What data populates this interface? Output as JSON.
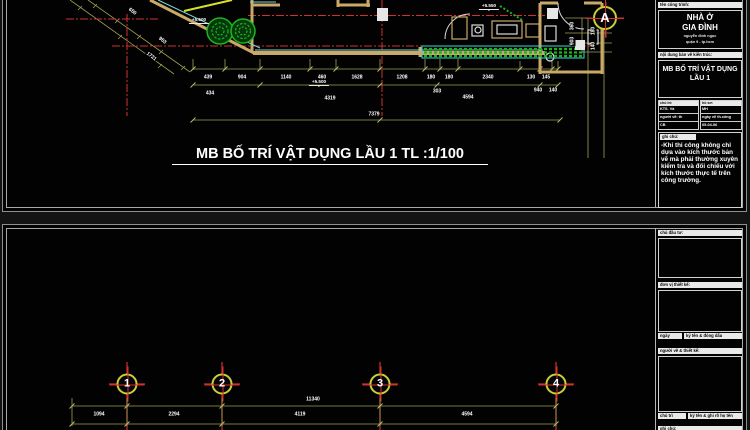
{
  "colors": {
    "wall": "#c9a868",
    "centerline": "#d23030",
    "dimension_line": "#9f9f55",
    "vegetation": "#1db31d",
    "cyan_accent": "#3ad6d6",
    "grid_bubble_ring": "#cbcd39",
    "sheet_frame": "#8f8f8f",
    "text": "#ffffff"
  },
  "sheet1": {
    "drawing_title": "MB BỐ TRÍ VẬT DỤNG LẦU 1 TL :1/100",
    "grid_bubbles": [
      {
        "t": "A",
        "x": 605,
        "y": 18
      }
    ],
    "levels": [
      {
        "t": "+5.500",
        "x": 199,
        "y": 17
      },
      {
        "t": "+5.500",
        "x": 319,
        "y": 79
      },
      {
        "t": "+5.550",
        "x": 489,
        "y": 3
      }
    ],
    "dims_row1": [
      {
        "t": "439",
        "x": 208,
        "y": 78
      },
      {
        "t": "904",
        "x": 242,
        "y": 78
      },
      {
        "t": "1140",
        "x": 286,
        "y": 78
      },
      {
        "t": "460",
        "x": 322,
        "y": 78
      },
      {
        "t": "1628",
        "x": 357,
        "y": 78
      },
      {
        "t": "1208",
        "x": 402,
        "y": 78
      },
      {
        "t": "180",
        "x": 431,
        "y": 78
      },
      {
        "t": "180",
        "x": 449,
        "y": 78
      },
      {
        "t": "2340",
        "x": 488,
        "y": 78
      },
      {
        "t": "130",
        "x": 531,
        "y": 78
      },
      {
        "t": "145",
        "x": 546,
        "y": 78
      }
    ],
    "dims_row2": [
      {
        "t": "434",
        "x": 210,
        "y": 94
      },
      {
        "t": "4319",
        "x": 330,
        "y": 99
      },
      {
        "t": "303",
        "x": 437,
        "y": 92
      },
      {
        "t": "940",
        "x": 538,
        "y": 91
      },
      {
        "t": "140",
        "x": 553,
        "y": 91
      },
      {
        "t": "4594",
        "x": 468,
        "y": 98
      }
    ],
    "dims_row3": [
      {
        "t": "7379",
        "x": 374,
        "y": 115
      }
    ],
    "dims_diag": [
      {
        "t": "650",
        "x": 132,
        "y": 12,
        "rot": 38
      },
      {
        "t": "953",
        "x": 162,
        "y": 41,
        "rot": 38
      },
      {
        "t": "1721",
        "x": 151,
        "y": 57,
        "rot": 38
      }
    ],
    "dims_vert": [
      {
        "t": "360",
        "x": 573,
        "y": 26,
        "rot": -90
      },
      {
        "t": "903",
        "x": 573,
        "y": 41,
        "rot": -90
      },
      {
        "t": "180",
        "x": 594,
        "y": 31,
        "rot": -90
      },
      {
        "t": "140",
        "x": 594,
        "y": 46,
        "rot": -90
      }
    ],
    "titleblock": {
      "header_project": "tên công trình:",
      "project_1": "NHÀ Ở",
      "project_2": "GIA ĐÌNH",
      "project_sub1": "nguyễn đình ngọc",
      "project_sub2": "quận 9 - tp.hcm",
      "header_drawing": "nội dung bản vẽ kiến trúc:",
      "drawing_1": "MB BỐ TRÍ VẬT DỤNG",
      "drawing_2": "LẦU 1",
      "left_col": {
        "header": "chủ trì:",
        "rows": [
          "KTS. Và",
          "người vẽ: th",
          "CB"
        ]
      },
      "right_col": {
        "header": "hồ sơ:",
        "rows": [
          "MH",
          "ngày vẽ th.công",
          "05-04-06"
        ]
      },
      "notes_header": "ghi chú:",
      "notes_body": "-Khi thi công không chỉ dựa vào kích thước bản vẽ mà phải thường xuyên kiểm tra và đối chiếu với kích thước thực tế trên công trường."
    }
  },
  "sheet2": {
    "grid_bubbles": [
      {
        "t": "1",
        "x": 127,
        "y": 384
      },
      {
        "t": "2",
        "x": 222,
        "y": 384
      },
      {
        "t": "3",
        "x": 380,
        "y": 384
      },
      {
        "t": "4",
        "x": 556,
        "y": 384
      }
    ],
    "dims_total": [
      {
        "t": "11340",
        "x": 313,
        "y": 400
      }
    ],
    "dims_row": [
      {
        "t": "1094",
        "x": 99,
        "y": 415
      },
      {
        "t": "2294",
        "x": 174,
        "y": 415
      },
      {
        "t": "4119",
        "x": 300,
        "y": 415
      },
      {
        "t": "4594",
        "x": 467,
        "y": 415
      }
    ],
    "titleblock": {
      "box1_header": "chủ đầu tư:",
      "box2_header": "đơn vị thiết kế:",
      "box2_foot_left": "ngày",
      "box2_foot_right": "ký tên & đóng dấu",
      "box3_header": "người vẽ & thiết kế:",
      "box3_foot_left": "chủ trì",
      "box3_foot_right": "ký tên & ghi rõ họ tên",
      "box4_header": "ghi chú:"
    }
  }
}
